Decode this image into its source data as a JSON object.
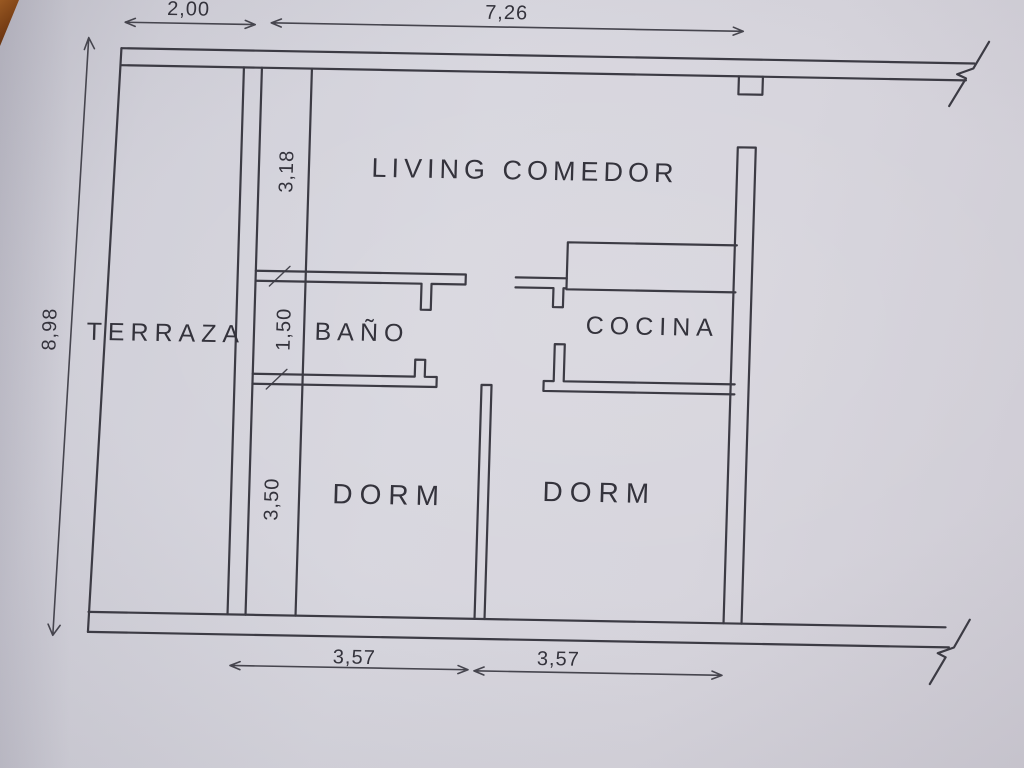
{
  "figure": {
    "kind": "hand-photographed apartment floor plan",
    "paper_color": "#d4d3db",
    "ink_color": "#3b3a43"
  },
  "rooms": [
    {
      "id": "terraza",
      "label": "TERRAZA"
    },
    {
      "id": "living-comedor",
      "label": "LIVING COMEDOR"
    },
    {
      "id": "bano",
      "label": "BAÑO"
    },
    {
      "id": "cocina",
      "label": "COCINA"
    },
    {
      "id": "dorm-1",
      "label": "DORM"
    },
    {
      "id": "dorm-2",
      "label": "DORM"
    }
  ],
  "dimensions": {
    "terraza_width": "2,00",
    "living_width": "7,26",
    "total_depth": "8,98",
    "living_depth": "3,18",
    "bano_depth": "1,50",
    "dorm_depth": "3,50",
    "dorm1_width": "3,57",
    "dorm2_width": "3,57"
  }
}
